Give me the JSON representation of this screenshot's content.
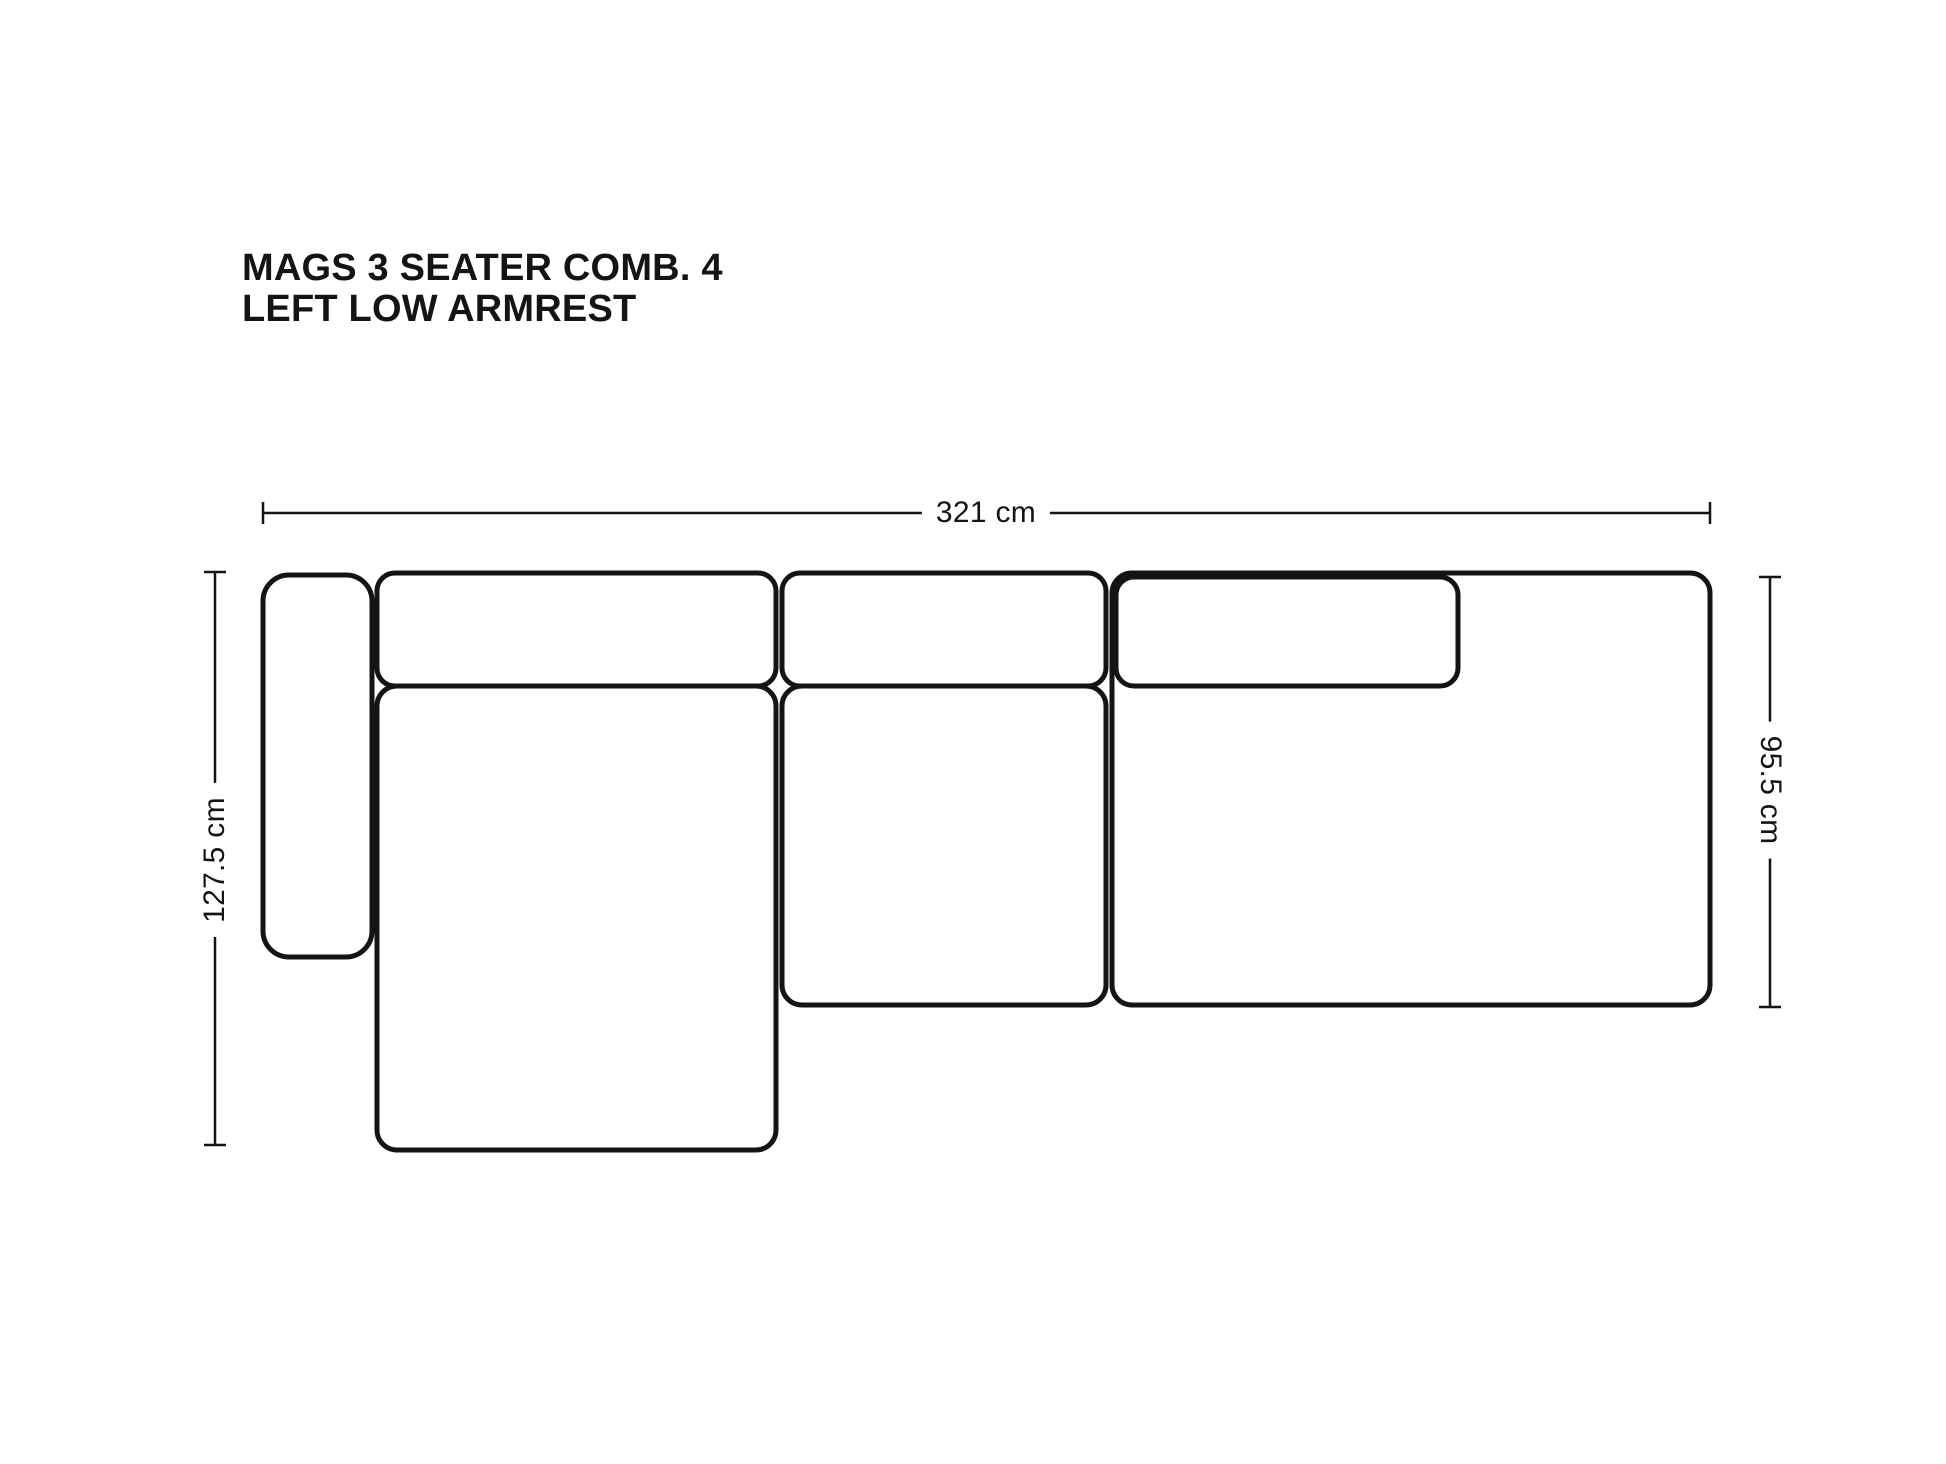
{
  "title": {
    "line1": "MAGS 3 SEATER COMB. 4",
    "line2": "LEFT LOW ARMREST"
  },
  "dimensions": {
    "overall_width": "321 cm",
    "chaise_depth": "127.5 cm",
    "seat_depth": "95.5 cm"
  },
  "colors": {
    "ink": "#141414",
    "background": "#ffffff"
  }
}
